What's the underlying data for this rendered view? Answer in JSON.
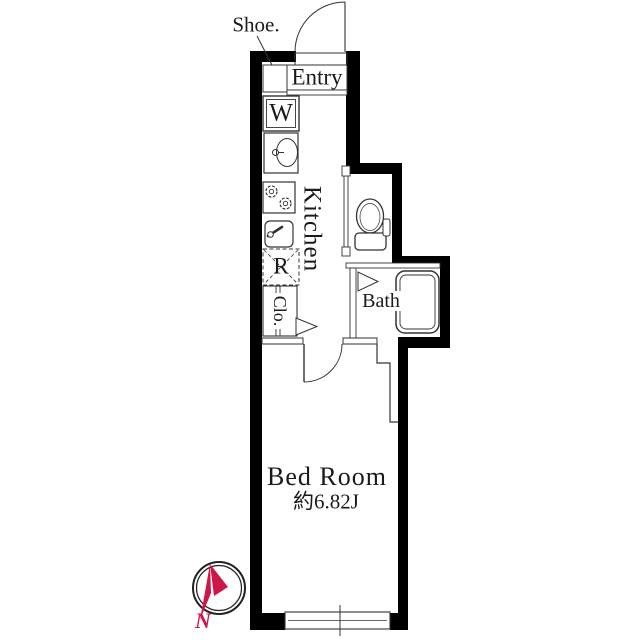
{
  "floorplan": {
    "title": "1K apartment floor plan",
    "rooms": {
      "shoe": {
        "label": "Shoe."
      },
      "entry": {
        "label": "Entry"
      },
      "washer": {
        "label": "W"
      },
      "kitchen": {
        "label": "Kitchen"
      },
      "refrigerator": {
        "label": "R"
      },
      "closet": {
        "label": "Clo."
      },
      "bath": {
        "label": "Bath"
      },
      "bedroom": {
        "label": "Bed Room",
        "size": "約6.82J"
      }
    },
    "compass": {
      "north_label": "N"
    },
    "colors": {
      "wall": "#000000",
      "line": "#333333",
      "background": "#ffffff",
      "compass_accent": "#cc1747",
      "text": "#1a1a1a"
    },
    "fixtures": [
      "entry-door",
      "shoe-cabinet",
      "washing-machine",
      "washbasin",
      "gas-stove",
      "kitchen-sink",
      "refrigerator-space",
      "closet",
      "toilet",
      "bathtub",
      "bath-folding-door",
      "closet-folding-door",
      "bedroom-door",
      "sliding-window",
      "compass-north"
    ]
  }
}
